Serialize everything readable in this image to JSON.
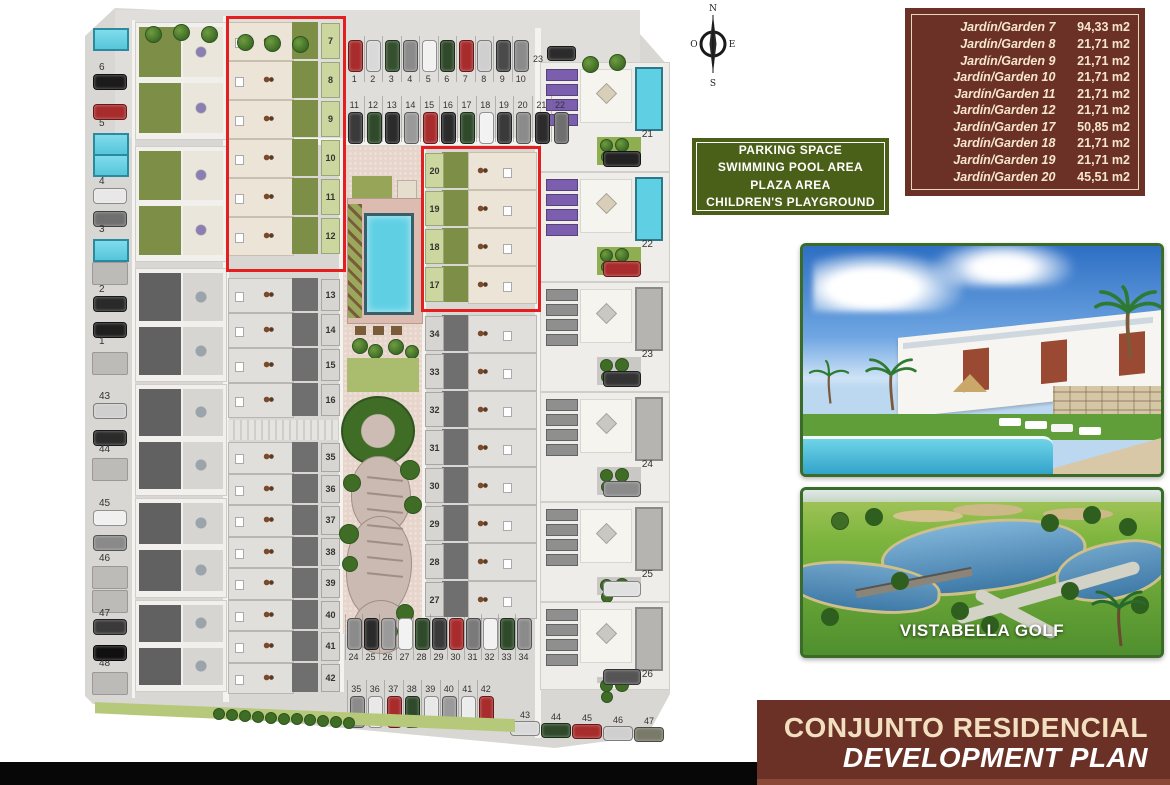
{
  "compass": {
    "n": "N",
    "s": "S",
    "e": "E",
    "w": "O"
  },
  "garden_table": {
    "rows": [
      {
        "label": "Jardín/Garden 7",
        "value": "94,33 m2"
      },
      {
        "label": "Jardín/Garden 8",
        "value": "21,71 m2"
      },
      {
        "label": "Jardín/Garden 9",
        "value": "21,71 m2"
      },
      {
        "label": "Jardín/Garden 10",
        "value": "21,71 m2"
      },
      {
        "label": "Jardín/Garden 11",
        "value": "21,71 m2"
      },
      {
        "label": "Jardín/Garden 12",
        "value": "21,71 m2"
      },
      {
        "label": "Jardín/Garden 17",
        "value": "50,85 m2"
      },
      {
        "label": "Jardín/Garden 18",
        "value": "21,71 m2"
      },
      {
        "label": "Jardín/Garden 19",
        "value": "21,71 m2"
      },
      {
        "label": "Jardín/Garden 20",
        "value": "45,51 m2"
      }
    ]
  },
  "amenities": {
    "lines": [
      "PARKING SPACE",
      "SWIMMING POOL AREA",
      "PLAZA AREA",
      "CHILDREN'S PLAYGROUND"
    ]
  },
  "photos": {
    "golf_caption": "VISTABELLA GOLF"
  },
  "banner": {
    "line1": "CONJUNTO RESIDENCIAL",
    "line2": "DEVELOPMENT PLAN"
  },
  "site_plan": {
    "top_parking_row1": {
      "numbers": [
        "1",
        "2",
        "3",
        "4",
        "5",
        "6",
        "7",
        "8",
        "9",
        "10"
      ],
      "car_colors": [
        "#a82c2c",
        "#d9d9d9",
        "#35502f",
        "#8b8b8b",
        "#f2f2f2",
        "#2f4a2a",
        "#a82c2c",
        "#cfcfcf",
        "#4a4a4a",
        "#8b8b8b"
      ]
    },
    "top_parking_row2": {
      "numbers": [
        "11",
        "12",
        "13",
        "14",
        "15",
        "16",
        "17",
        "18",
        "19",
        "20",
        "21",
        "22"
      ],
      "car_colors": [
        "#3a3a3a",
        "#2f4a2a",
        "#2b2b2b",
        "#9a9a9a",
        "#a82c2c",
        "#2b2b2b",
        "#2f4a2a",
        "#f2f2f2",
        "#3a3a3a",
        "#8b8b8b",
        "#2b2b2b",
        "#6f6f6f"
      ]
    },
    "single_parking": {
      "number": "23",
      "car_color": "#2b2b2b"
    },
    "bottom_parking_row1": {
      "numbers": [
        "24",
        "25",
        "26",
        "27",
        "28",
        "29",
        "30",
        "31",
        "32",
        "33",
        "34"
      ],
      "car_colors": [
        "#8b8b8b",
        "#2b2b2b",
        "#9a9a9a",
        "#f2f2f2",
        "#2f4a2a",
        "#3a3a3a",
        "#a82c2c",
        "#7a7a7a",
        "#f2f2f2",
        "#2f4a2a",
        "#8b8b8b"
      ]
    },
    "bottom_parking_row2": {
      "numbers": [
        "35",
        "36",
        "37",
        "38",
        "39",
        "40",
        "41",
        "42"
      ],
      "car_colors": [
        "#8b8b8b",
        "#e8e8e8",
        "#a82c2c",
        "#2f4a2a",
        "#e8e8e8",
        "#9a9a9a",
        "#ececec",
        "#a82c2c"
      ]
    },
    "bottom_right_parking": {
      "numbers": [
        "43",
        "44",
        "45",
        "46",
        "47"
      ],
      "car_colors": [
        "#d9d9d9",
        "#2f4a2a",
        "#a82c2c",
        "#cfcfcf",
        "#7a7a6a"
      ]
    },
    "left_strip_items": [
      {
        "type": "pool",
        "y": 20
      },
      {
        "type": "label",
        "text": "6",
        "y": 54
      },
      {
        "type": "car",
        "color": "#1b1b1b",
        "y": 66
      },
      {
        "type": "car",
        "color": "#a82c2c",
        "y": 96
      },
      {
        "type": "label",
        "text": "5",
        "y": 110
      },
      {
        "type": "pool",
        "y": 125
      },
      {
        "type": "pool",
        "y": 146
      },
      {
        "type": "label",
        "text": "4",
        "y": 168
      },
      {
        "type": "car",
        "color": "#e8e8e8",
        "y": 180
      },
      {
        "type": "car",
        "color": "#6f6f6f",
        "y": 203
      },
      {
        "type": "label",
        "text": "3",
        "y": 216
      },
      {
        "type": "pool",
        "y": 231
      },
      {
        "type": "plot",
        "y": 254
      },
      {
        "type": "label",
        "text": "2",
        "y": 276
      },
      {
        "type": "car",
        "color": "#2a2a2a",
        "y": 288
      },
      {
        "type": "car",
        "color": "#1f1f1f",
        "y": 314
      },
      {
        "type": "label",
        "text": "1",
        "y": 328
      },
      {
        "type": "plot",
        "y": 344
      },
      {
        "type": "label",
        "text": "43",
        "y": 383
      },
      {
        "type": "car",
        "color": "#cfcfcf",
        "y": 395
      },
      {
        "type": "car",
        "color": "#2b2b2b",
        "y": 422
      },
      {
        "type": "label",
        "text": "44",
        "y": 436
      },
      {
        "type": "plot",
        "y": 450
      },
      {
        "type": "label",
        "text": "45",
        "y": 490
      },
      {
        "type": "car",
        "color": "#f0f0f0",
        "y": 502
      },
      {
        "type": "car",
        "color": "#8a8a8a",
        "y": 527
      },
      {
        "type": "label",
        "text": "46",
        "y": 545
      },
      {
        "type": "plot",
        "y": 558
      },
      {
        "type": "plot",
        "y": 582
      },
      {
        "type": "label",
        "text": "47",
        "y": 600
      },
      {
        "type": "car",
        "color": "#3a3a3a",
        "y": 611
      },
      {
        "type": "car",
        "color": "#101010",
        "y": 637
      },
      {
        "type": "label",
        "text": "48",
        "y": 650
      },
      {
        "type": "plot",
        "y": 664
      }
    ],
    "center_left_units": {
      "colored": [
        "7",
        "8",
        "9",
        "10",
        "11",
        "12"
      ],
      "gray_a": [
        "13",
        "14",
        "15",
        "16"
      ],
      "gray_b": [
        "35",
        "36",
        "37",
        "38",
        "39",
        "40",
        "41",
        "42"
      ]
    },
    "center_right_units": {
      "colored": [
        "20",
        "19",
        "18",
        "17"
      ],
      "gray": [
        "34",
        "33",
        "32",
        "31",
        "30",
        "29",
        "28",
        "27"
      ]
    },
    "right_villas": [
      {
        "label": "21",
        "colored": true,
        "car": "#222222"
      },
      {
        "label": "22",
        "colored": true,
        "car": "#a82c2c"
      },
      {
        "label": "23",
        "colored": false,
        "car": "#333333"
      },
      {
        "label": "24",
        "colored": false,
        "car": "#8b8b8b"
      },
      {
        "label": "25",
        "colored": false,
        "car": "#e0e0e0"
      },
      {
        "label": "26",
        "colored": false,
        "car": "#555555"
      }
    ],
    "colors": {
      "accent_red": "#e31f1f",
      "maroon": "#6b3126",
      "cream": "#f2dfc0",
      "green_box": "#4a5f17",
      "pool_cyan": "#5fd0e4",
      "garden_green": "#7d8f47",
      "chip_green": "#cbd79e",
      "chip_gray": "#d6d5d1",
      "gray_garden": "#6f6f6f",
      "frame_green": "#3a6b28",
      "panel_purple": "#7b5fae"
    }
  }
}
